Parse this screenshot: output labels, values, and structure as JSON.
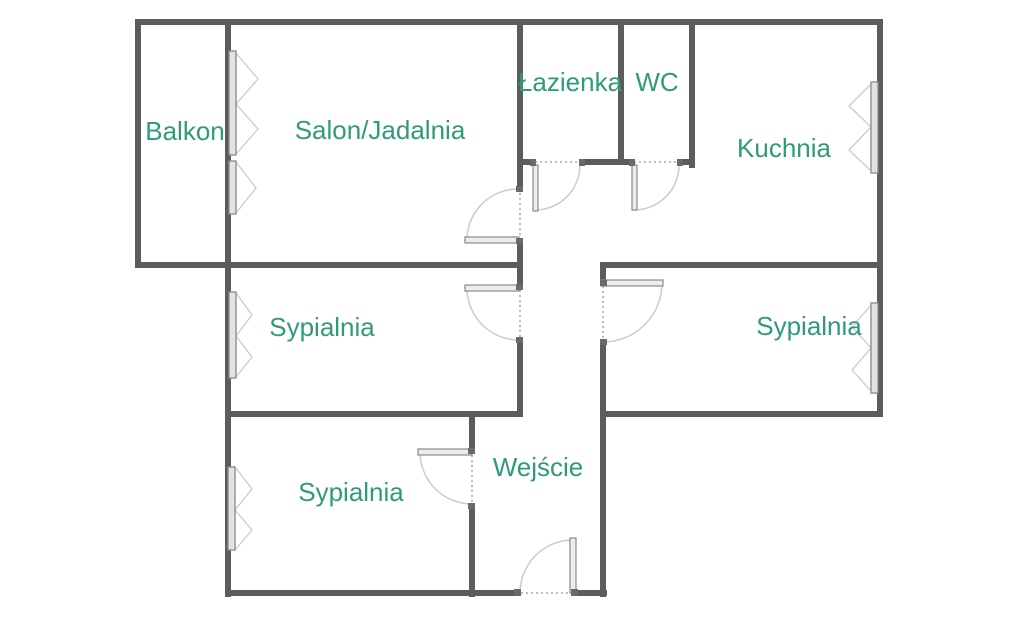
{
  "floorplan": {
    "rooms": [
      {
        "id": "balkon",
        "label": "Balkon"
      },
      {
        "id": "salon_jadalnia",
        "label": "Salon/Jadalnia"
      },
      {
        "id": "lazienka",
        "label": "Łazienka"
      },
      {
        "id": "wc",
        "label": "WC"
      },
      {
        "id": "kuchnia",
        "label": "Kuchnia"
      },
      {
        "id": "sypialnia_middle_left",
        "label": "Sypialnia"
      },
      {
        "id": "sypialnia_middle_right",
        "label": "Sypialnia"
      },
      {
        "id": "sypialnia_bottom",
        "label": "Sypialnia"
      },
      {
        "id": "wejscie",
        "label": "Wejście"
      }
    ],
    "symbols": {
      "door_count": 7,
      "window_count": 6,
      "door_symbol": "quarter-circle-swing-arc",
      "window_symbol": "casement-bar-with-opening-triangles"
    },
    "colors": {
      "background": "#ffffff",
      "wall": "#5c5c5c",
      "label": "#2f9b7b",
      "symbol": "#cbcbcb",
      "dash": "#bdbdbd"
    }
  }
}
